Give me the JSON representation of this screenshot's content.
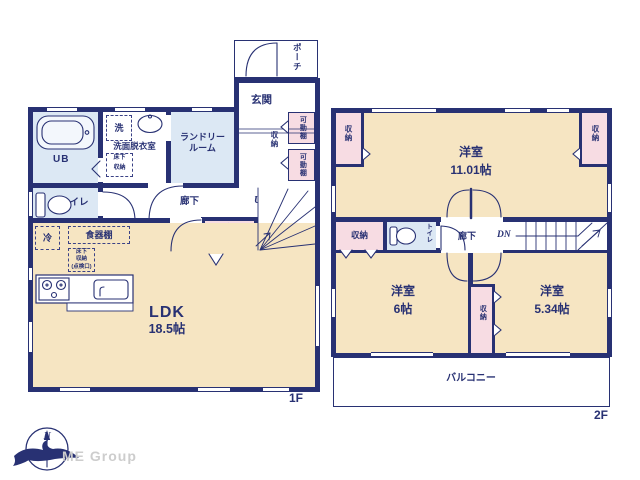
{
  "meta": {
    "floor1_label": "1F",
    "floor2_label": "2F"
  },
  "colors": {
    "wall_navy": "#283173",
    "room_cream": "#f6e5c2",
    "room_blue": "#dce8f4",
    "closet_pink": "#f7dce3",
    "brand_gray": "#cdcdcd"
  },
  "floor1": {
    "porch": "ポーチ",
    "entrance": "玄関",
    "entrance_storage": "収納",
    "shelf_top": "可動棚",
    "shelf_bottom": "可動棚",
    "bath": "UB",
    "washer": "洗",
    "washroom": "洗面脱衣室",
    "underfloor_l1": "床下",
    "underfloor_l2": "収納",
    "laundry_l1": "ランドリー",
    "laundry_l2": "ルーム",
    "toilet": "トイレ",
    "hallway": "廊下",
    "up": "UP",
    "understairs_l1": "階段下",
    "understairs_l2": "収納",
    "fridge": "冷",
    "cupboard": "食器棚",
    "hatch_l1": "床下",
    "hatch_l2": "収納",
    "hatch_l3": "(点検口)",
    "ldk_name": "LDK",
    "ldk_size": "18.5帖"
  },
  "floor2": {
    "room_main_name": "洋室",
    "room_main_size": "11.01帖",
    "closet_tl": "収納",
    "closet_tr": "収納",
    "closet_ml": "収納",
    "closet_center": "収納",
    "toilet": "トイレ",
    "hallway": "廊下",
    "dn": "DN",
    "room_b_name": "洋室",
    "room_b_size": "6帖",
    "room_c_name": "洋室",
    "room_c_size": "5.34帖",
    "balcony": "バルコニー"
  },
  "footer": {
    "compass_north": "N",
    "brand": "ME Group"
  }
}
